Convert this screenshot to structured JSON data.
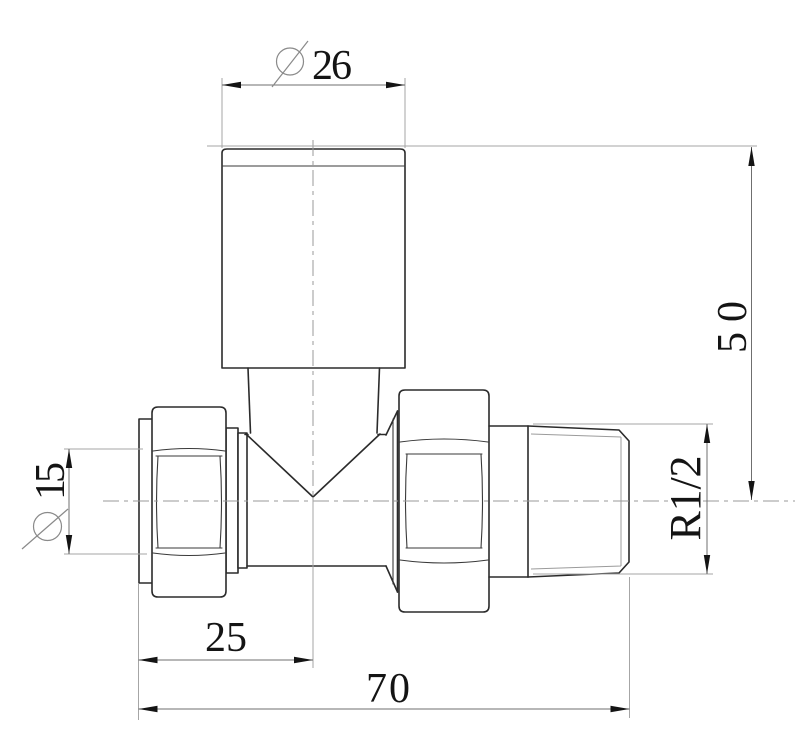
{
  "diagram": {
    "kind": "technical-drawing",
    "colors": {
      "background": "#ffffff",
      "outline": "#2b2b2b",
      "thin_line": "#9b9b9b",
      "extension_line": "#a6a6a6",
      "dimension_text": "#141414"
    },
    "dimensions": {
      "cap_diameter": {
        "symbol": "diameter",
        "value": "26"
      },
      "overall_height": {
        "value": "50"
      },
      "thread_size": {
        "value": "R1/2"
      },
      "pipe_diameter": {
        "symbol": "diameter",
        "value": "15"
      },
      "inlet_to_center": {
        "value": "25"
      },
      "overall_length": {
        "value": "70"
      }
    }
  }
}
